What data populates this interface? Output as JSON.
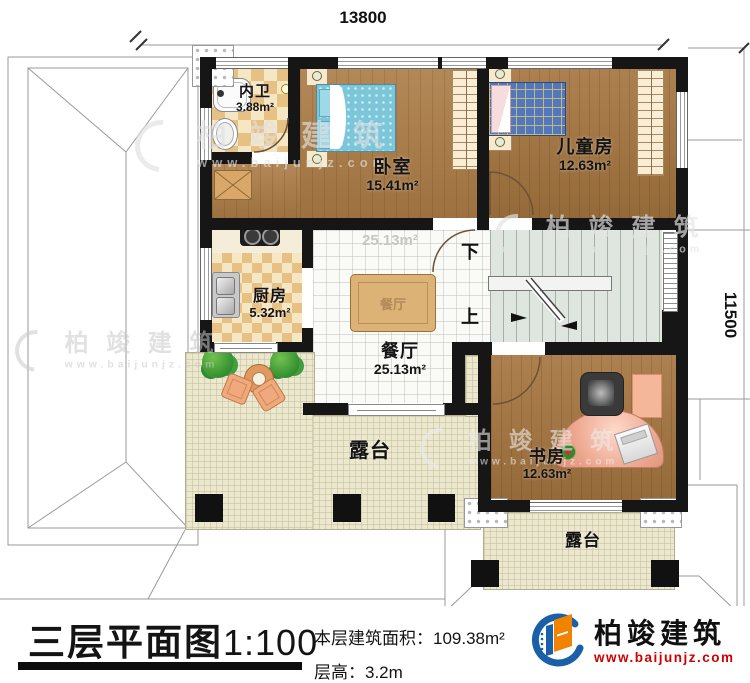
{
  "plan": {
    "dim_top": "13800",
    "dim_right": "11500",
    "stairs_down": "下",
    "stairs_up": "上",
    "ghost_area": "25.13m²",
    "rooms": {
      "bathroom": {
        "name": "内卫",
        "area": "3.88m²"
      },
      "bedroom": {
        "name": "卧室",
        "area": "15.41m²"
      },
      "kids": {
        "name": "儿童房",
        "area": "12.63m²"
      },
      "kitchen": {
        "name": "厨房",
        "area": "5.32m²"
      },
      "dining": {
        "name": "餐厅",
        "area": "25.13m²"
      },
      "study": {
        "name": "书房",
        "area": "12.63m²"
      },
      "terrace_main": {
        "name": "露台"
      },
      "terrace_small": {
        "name": "露台"
      }
    }
  },
  "titleblock": {
    "title": "三层平面图",
    "scale": "1:100",
    "area_label": "本层建筑面积：",
    "area_value": "109.38m²",
    "height_label": "层高：",
    "height_value": "3.2m"
  },
  "brand": {
    "name": "柏竣建筑",
    "url": "www.baijunjz.com"
  },
  "colors": {
    "wall": "#161616",
    "accent_blue": "#1a5fa8",
    "accent_orange": "#f08300",
    "url_red": "#cf0000"
  }
}
